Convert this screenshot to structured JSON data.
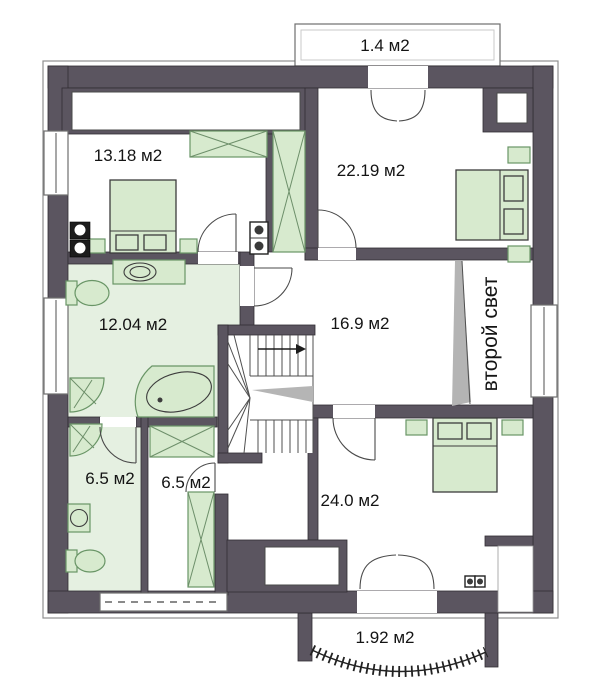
{
  "plan": {
    "type": "floor-plan",
    "area_unit": "м2",
    "rooms": [
      {
        "id": "balcony-top",
        "label": "1.4 м2"
      },
      {
        "id": "bedroom-top-left",
        "label": "13.18 м2"
      },
      {
        "id": "bedroom-top-right",
        "label": "22.19 м2"
      },
      {
        "id": "bathroom",
        "label": "12.04 м2"
      },
      {
        "id": "hall",
        "label": "16.9 м2"
      },
      {
        "id": "void",
        "label": "второй свет"
      },
      {
        "id": "wc",
        "label": "6.5 м2"
      },
      {
        "id": "dressing",
        "label": "6.5 м2"
      },
      {
        "id": "bedroom-bottom",
        "label": "24.0 м2"
      },
      {
        "id": "balcony-bottom",
        "label": "1.92 м2"
      }
    ],
    "colors": {
      "wall": "#5b5560",
      "floor_tint": "#e5f0e1",
      "furniture_fill": "#d7eace",
      "furniture_stroke": "#699566",
      "text": "#141414"
    }
  }
}
